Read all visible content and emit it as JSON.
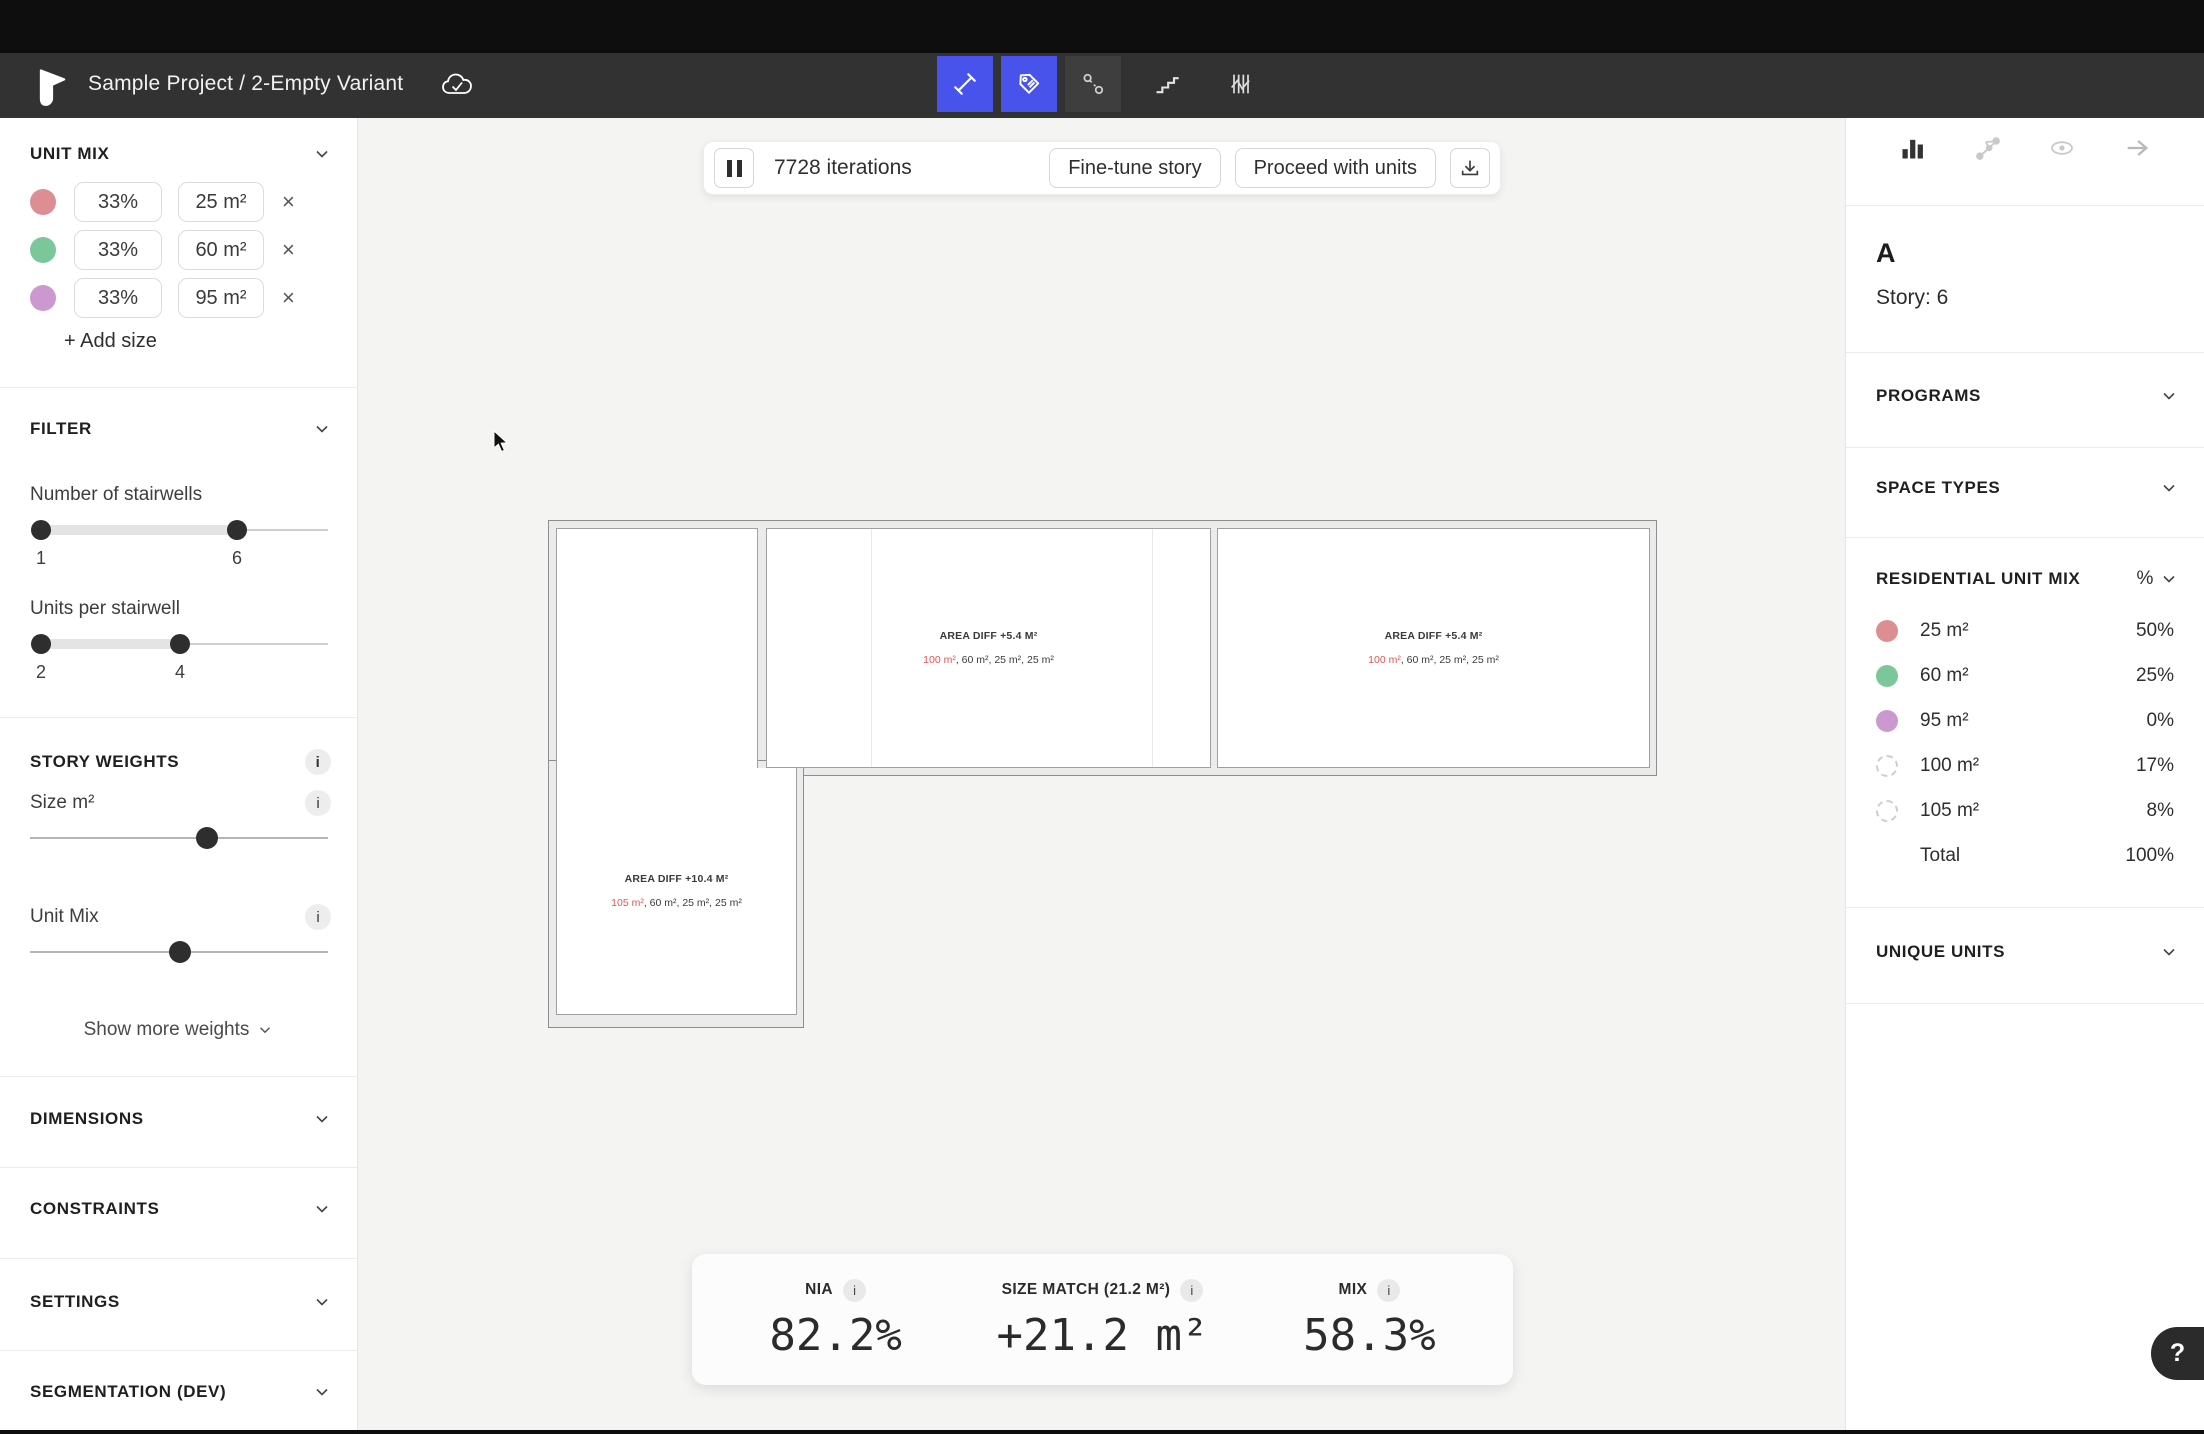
{
  "colors": {
    "pink": "#dc8e92",
    "green": "#7cc79a",
    "purple": "#cc98d0",
    "red_text": "#e05555",
    "accent_blue": "#4753ea"
  },
  "ui": {
    "info_glyph": "i",
    "close_glyph": "×",
    "help_glyph": "?"
  },
  "header": {
    "title": "Sample Project / 2-Empty Variant"
  },
  "left_panel": {
    "unit_mix": {
      "title": "UNIT MIX",
      "rows": [
        {
          "pct": "33%",
          "size": "25 m²"
        },
        {
          "pct": "33%",
          "size": "60 m²"
        },
        {
          "pct": "33%",
          "size": "95 m²"
        }
      ],
      "add_label": "+ Add size"
    },
    "filter": {
      "title": "FILTER",
      "sliders": [
        {
          "label": "Number of stairwells",
          "min_label": "1",
          "max_label": "6"
        },
        {
          "label": "Units per stairwell",
          "min_label": "2",
          "max_label": "4"
        }
      ]
    },
    "story_weights": {
      "title": "STORY WEIGHTS",
      "sliders": [
        {
          "label": "Size m²"
        },
        {
          "label": "Unit Mix"
        }
      ],
      "show_more": "Show more weights"
    },
    "sections": {
      "dimensions": "DIMENSIONS",
      "constraints": "CONSTRAINTS",
      "settings": "SETTINGS",
      "segmentation": "SEGMENTATION (DEV)"
    }
  },
  "canvas": {
    "iterations": {
      "count_label": "7728 iterations",
      "fine_tune": "Fine-tune story",
      "proceed": "Proceed with units"
    },
    "plan_labels": [
      {
        "title": "AREA DIFF +5.4 M²",
        "units_red": "100 m²",
        "units_rest": ", 60 m², 25 m², 25 m²"
      },
      {
        "title": "AREA DIFF +5.4 M²",
        "units_red": "100 m²",
        "units_rest": ", 60 m², 25 m², 25 m²"
      },
      {
        "title": "AREA DIFF +10.4 M²",
        "units_red": "105 m²",
        "units_rest": ", 60 m², 25 m², 25 m²"
      }
    ],
    "stats": [
      {
        "label": "NIA",
        "value": "82.2%"
      },
      {
        "label": "SIZE MATCH (21.2 M²)",
        "value": "+21.2 m²"
      },
      {
        "label": "MIX",
        "value": "58.3%"
      }
    ]
  },
  "right_panel": {
    "variant": {
      "name": "A",
      "story": "Story: 6"
    },
    "programs_title": "PROGRAMS",
    "space_types_title": "SPACE TYPES",
    "unique_units_title": "UNIQUE UNITS",
    "unit_mix": {
      "title": "RESIDENTIAL UNIT MIX",
      "unit_toggle": "%",
      "rows": [
        {
          "label": "25 m²",
          "value": "50%",
          "dashed": false
        },
        {
          "label": "60 m²",
          "value": "25%",
          "dashed": false
        },
        {
          "label": "95 m²",
          "value": "0%",
          "dashed": false
        },
        {
          "label": "100 m²",
          "value": "17%",
          "dashed": true
        },
        {
          "label": "105 m²",
          "value": "8%",
          "dashed": true
        }
      ],
      "total_label": "Total",
      "total_value": "100%"
    }
  }
}
